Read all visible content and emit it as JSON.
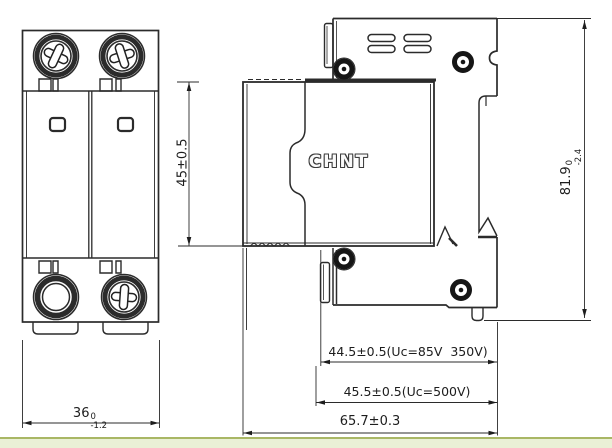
{
  "drawing": {
    "title_logo": "CHNT",
    "front_view": {
      "width": {
        "value": "36",
        "tol_upper": "0",
        "tol_lower": "-1.2"
      },
      "height": "45±0.5"
    },
    "side_view": {
      "height": {
        "value": "81.9",
        "tol_upper": "0",
        "tol_lower": "-2.4"
      },
      "depth_variant_85v": "44.5±0.5(Uc=85V  350V)",
      "depth_variant_500v": "45.5±0.5(Uc=500V)",
      "depth_total": "65.7±0.3"
    },
    "colors": {
      "line": "#2b2b2b",
      "screw_dark": "#161616",
      "footer_fill": "#eaf0d6",
      "footer_border": "#a9b765"
    }
  }
}
